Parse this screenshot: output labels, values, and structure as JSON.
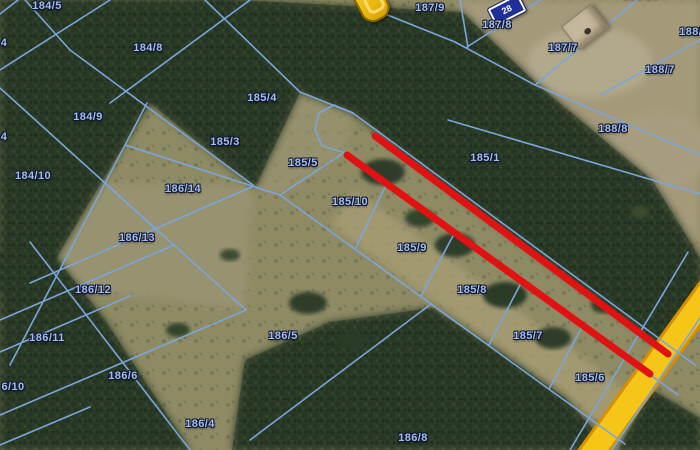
{
  "map": {
    "labels": [
      {
        "text": "184/5",
        "x": 47,
        "y": 6
      },
      {
        "text": "184/8",
        "x": 148,
        "y": 48
      },
      {
        "text": "184/9",
        "x": 88,
        "y": 117
      },
      {
        "text": "184/10",
        "x": 33,
        "y": 176
      },
      {
        "text": "4",
        "x": 4,
        "y": 43
      },
      {
        "text": "4",
        "x": 4,
        "y": 137
      },
      {
        "text": "6/10",
        "x": 13,
        "y": 387
      },
      {
        "text": "184/7",
        "x": 228,
        "y": -7
      },
      {
        "text": "185/4",
        "x": 262,
        "y": 98
      },
      {
        "text": "185/3",
        "x": 225,
        "y": 142
      },
      {
        "text": "185/5",
        "x": 303,
        "y": 163
      },
      {
        "text": "185/10",
        "x": 350,
        "y": 202
      },
      {
        "text": "185/9",
        "x": 412,
        "y": 248
      },
      {
        "text": "185/8",
        "x": 472,
        "y": 290
      },
      {
        "text": "185/7",
        "x": 528,
        "y": 336
      },
      {
        "text": "185/6",
        "x": 590,
        "y": 378
      },
      {
        "text": "185/1",
        "x": 485,
        "y": 158
      },
      {
        "text": "186/14",
        "x": 183,
        "y": 189
      },
      {
        "text": "186/13",
        "x": 137,
        "y": 238
      },
      {
        "text": "186/12",
        "x": 93,
        "y": 290
      },
      {
        "text": "186/11",
        "x": 47,
        "y": 338
      },
      {
        "text": "186/6",
        "x": 123,
        "y": 376
      },
      {
        "text": "186/4",
        "x": 200,
        "y": 424
      },
      {
        "text": "186/5",
        "x": 283,
        "y": 336
      },
      {
        "text": "186/8",
        "x": 413,
        "y": 438
      },
      {
        "text": "187/9",
        "x": 430,
        "y": 8
      },
      {
        "text": "187/8",
        "x": 497,
        "y": 25
      },
      {
        "text": "187/7",
        "x": 563,
        "y": 48
      },
      {
        "text": "188/10",
        "x": 641,
        "y": -5
      },
      {
        "text": "188/6",
        "x": 694,
        "y": 32
      },
      {
        "text": "188/7",
        "x": 660,
        "y": 70
      },
      {
        "text": "188/8",
        "x": 613,
        "y": 129
      }
    ],
    "boundaries": [
      {
        "points": "18,0 0,14"
      },
      {
        "points": "110,0 0,70"
      },
      {
        "points": "205,0 300,92"
      },
      {
        "points": "250,0 110,103"
      },
      {
        "points": "25,0 70,50"
      },
      {
        "points": "70,50 253,185"
      },
      {
        "points": "0,88 105,183 160,233"
      },
      {
        "points": "147,103 10,365"
      },
      {
        "points": "125,145 280,195"
      },
      {
        "points": "30,283 254,186"
      },
      {
        "points": "0,320 174,245"
      },
      {
        "points": "0,352 130,296"
      },
      {
        "points": "0,415 246,310"
      },
      {
        "points": "0,445 90,407"
      },
      {
        "points": "105,183 246,310"
      },
      {
        "points": "30,242 190,450"
      },
      {
        "points": "250,440 431,304"
      },
      {
        "points": "280,195 625,444"
      },
      {
        "points": "300,92 353,113"
      },
      {
        "points": "353,113 334,105 319,113 315,130 322,146 346,153"
      },
      {
        "points": "353,113 695,365"
      },
      {
        "points": "346,153 678,395"
      },
      {
        "points": "280,195 345,152"
      },
      {
        "points": "387,183 355,249"
      },
      {
        "points": "455,232 421,296"
      },
      {
        "points": "522,281 489,345"
      },
      {
        "points": "583,325 549,389"
      },
      {
        "points": "370,8 455,42 535,85"
      },
      {
        "points": "448,120 700,194"
      },
      {
        "points": "535,85 700,155"
      },
      {
        "points": "600,95 700,40"
      },
      {
        "points": "637,0 535,85"
      },
      {
        "points": "540,0 467,47"
      },
      {
        "points": "460,0 468,47"
      },
      {
        "points": "688,252 570,450"
      },
      {
        "points": "700,318 612,450"
      }
    ],
    "road": {
      "points": "726,268 580,470",
      "width": 22,
      "casing_width": 28
    },
    "red_lines": [
      {
        "x1": 375,
        "y1": 136,
        "x2": 668,
        "y2": 354
      },
      {
        "x1": 347,
        "y1": 155,
        "x2": 650,
        "y2": 374
      }
    ],
    "red_width": 7
  },
  "markers": {
    "sign": {
      "text": "28",
      "x": 507,
      "y": 10
    },
    "pin": {
      "x": 371,
      "y": 1
    },
    "structure": {
      "x": 585,
      "y": 27
    }
  },
  "colors": {
    "boundary": "#7aa6dc",
    "red": "#e11212",
    "road_fill": "#f5c518",
    "road_casing": "#d88f00",
    "label_fill": "#a8bce8",
    "label_outline": "#0c1834",
    "sign_bg": "#1e2f9b",
    "pin": "#f2c11a"
  }
}
